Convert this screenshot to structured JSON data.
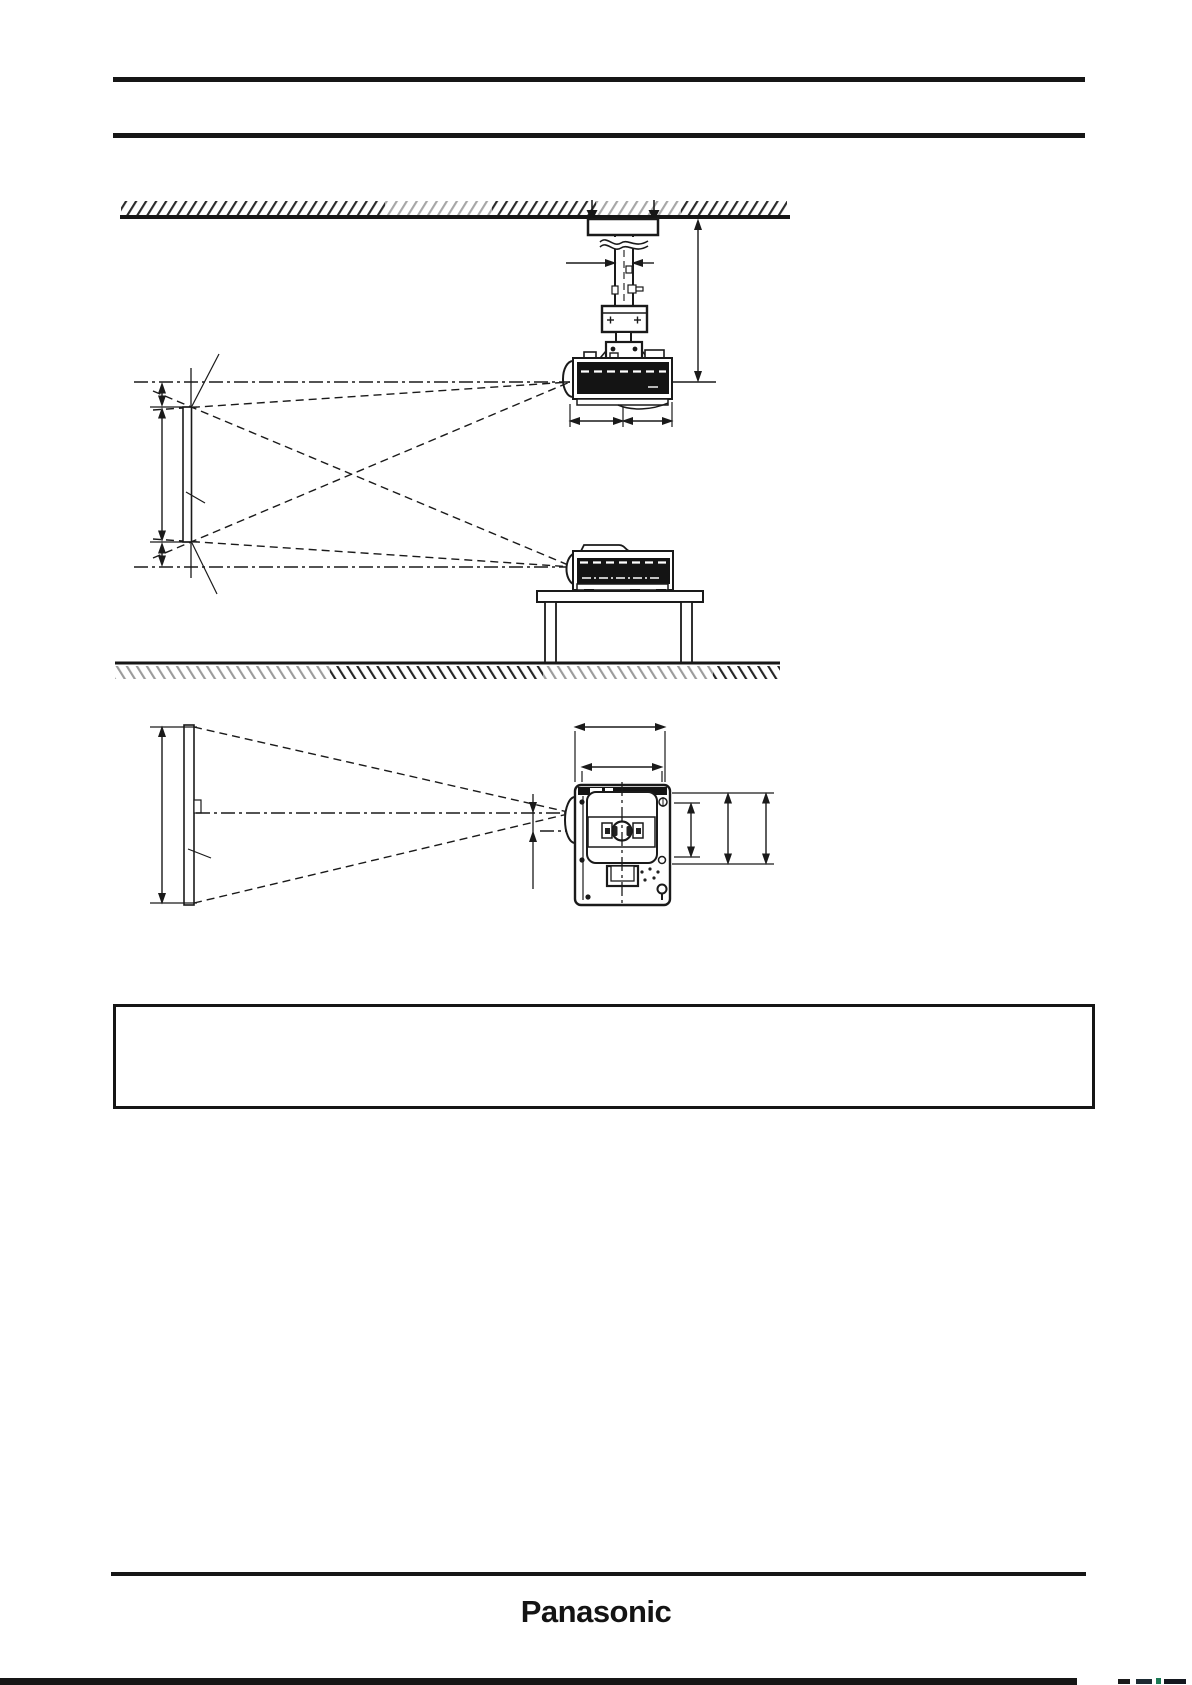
{
  "document": {
    "kind": "projector installation dimensions page",
    "footer_logo": "Panasonic",
    "note_box_text": "",
    "colors": {
      "ink": "#1a1a1a",
      "paper": "#ffffff",
      "hatch_light": "#9b9b9b",
      "hatch_dark": "#1f1f1f",
      "projector_body": "#141414"
    }
  }
}
